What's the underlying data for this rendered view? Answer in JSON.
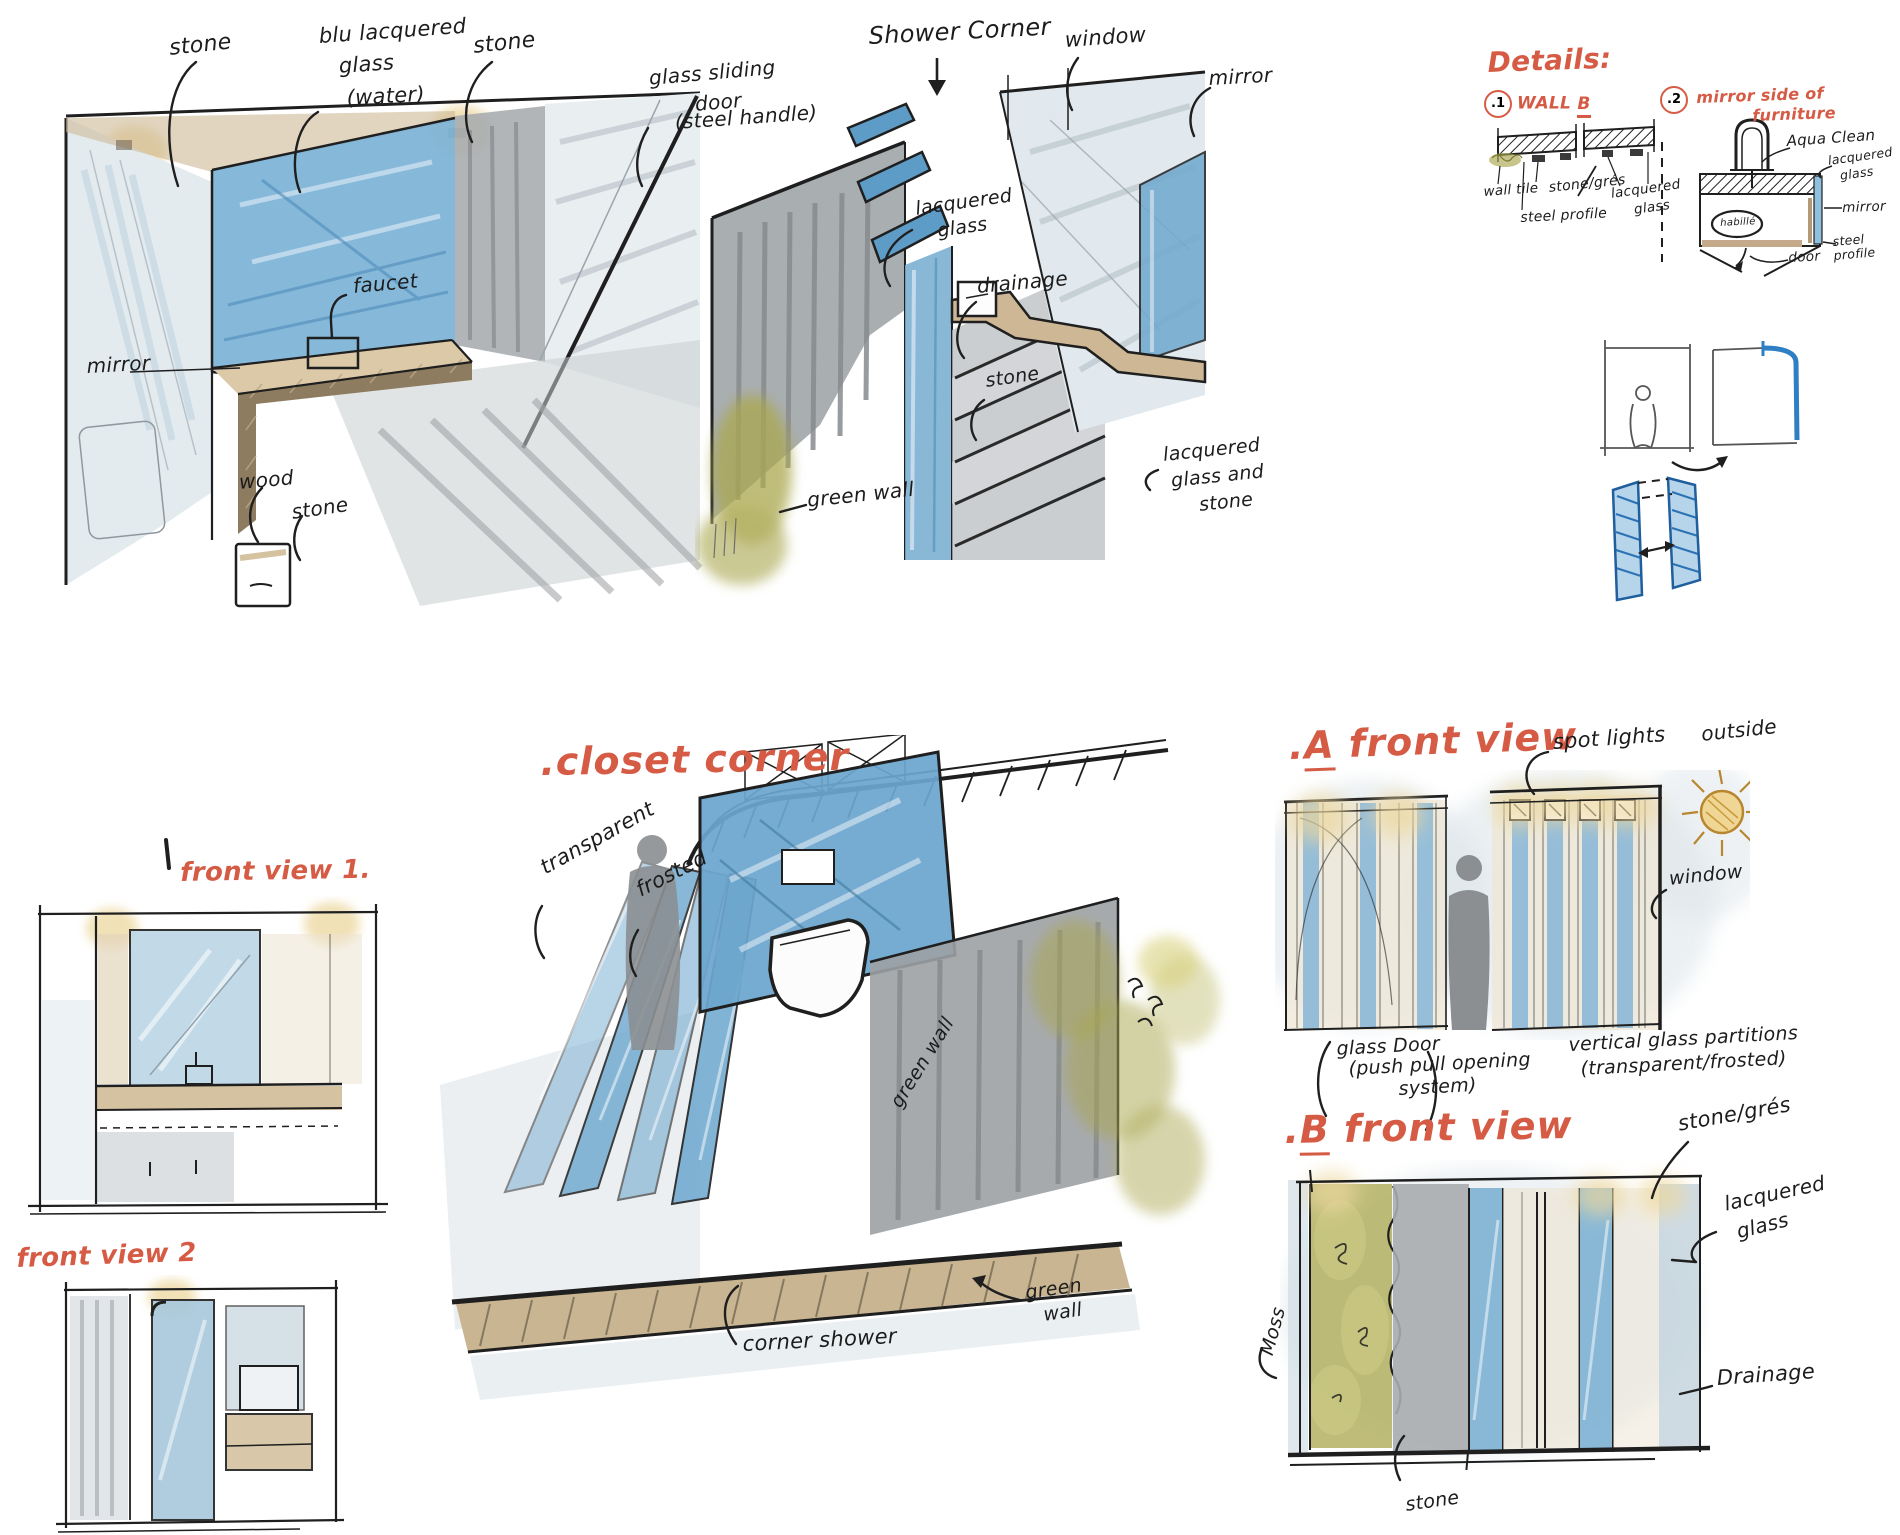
{
  "canvas": {
    "width": 1900,
    "height": 1535
  },
  "palette": {
    "ink": "#1f1f1f",
    "red": "#d65b45",
    "blue_glass": "#74abd1",
    "blue_deep": "#4a90c8",
    "wash_blue": "#dde5ea",
    "stone_gray": "#a6abae",
    "tan": "#d5c2a0",
    "olive_green": "#aaa74e",
    "yellow_glow": "#ecd79e"
  },
  "vanity": {
    "stone_a": "stone",
    "blu_1": "blu lacquered",
    "blu_2": "glass",
    "blu_3": "(water)",
    "stone_b": "stone",
    "door_1": "glass sliding",
    "door_2": "door",
    "door_3": "(steel handle)",
    "mirror": "mirror",
    "faucet": "faucet",
    "wood": "wood",
    "stone_c": "stone"
  },
  "shower": {
    "title": "Shower Corner",
    "window": "window",
    "mirror": "mirror",
    "lac_1": "lacquered",
    "lac_2": "glass",
    "drainage": "drainage",
    "stone_a": "stone",
    "lgs_1": "lacquered",
    "lgs_2": "glass and",
    "lgs_3": "stone",
    "green_wall": "green wall"
  },
  "details": {
    "title": "Details:",
    "d1_num": ".1",
    "d1_wall": "WALL",
    "d1_letter": "B",
    "d1_wall_tile": "wall tile",
    "d1_stone": "stone/grés",
    "d1_lac_1": "lacquered",
    "d1_lac_2": "glass",
    "d1_steel": "steel profile",
    "d2_num": ".2",
    "d2_title_1": "mirror side of",
    "d2_title_2": "furniture",
    "d2_aqua": "Aqua Clean",
    "d2_lac_1": "lacquered",
    "d2_lac_2": "glass",
    "d2_mirror": "mirror",
    "d2_steel_1": "steel",
    "d2_steel_2": "profile",
    "d2_door": "door",
    "d2_oval": "habillé"
  },
  "closet": {
    "title": ".closet corner",
    "transparent": "transparent",
    "frosted": "frosted",
    "corner_shower": "corner shower",
    "green_1": "green",
    "green_2": "wall",
    "green_side": "green wall"
  },
  "fv1": {
    "title": "front view 1."
  },
  "fv2": {
    "title": "front view 2"
  },
  "afront": {
    "dot": ".",
    "letter": "A",
    "rest": " front view",
    "spot": "spot lights",
    "outside": "outside",
    "window": "window",
    "gd_1": "glass Door",
    "gd_2": "(push pull opening",
    "gd_3": "system)",
    "vp_1": "vertical glass partitions",
    "vp_2": "(transparent/frosted)"
  },
  "bfront": {
    "dot": ".",
    "letter": "B",
    "rest": " front view",
    "stone_gres": "stone/grés",
    "lac_1": "lacquered",
    "lac_2": "glass",
    "moss": "Moss",
    "drainage": "Drainage",
    "stone": "stone"
  }
}
